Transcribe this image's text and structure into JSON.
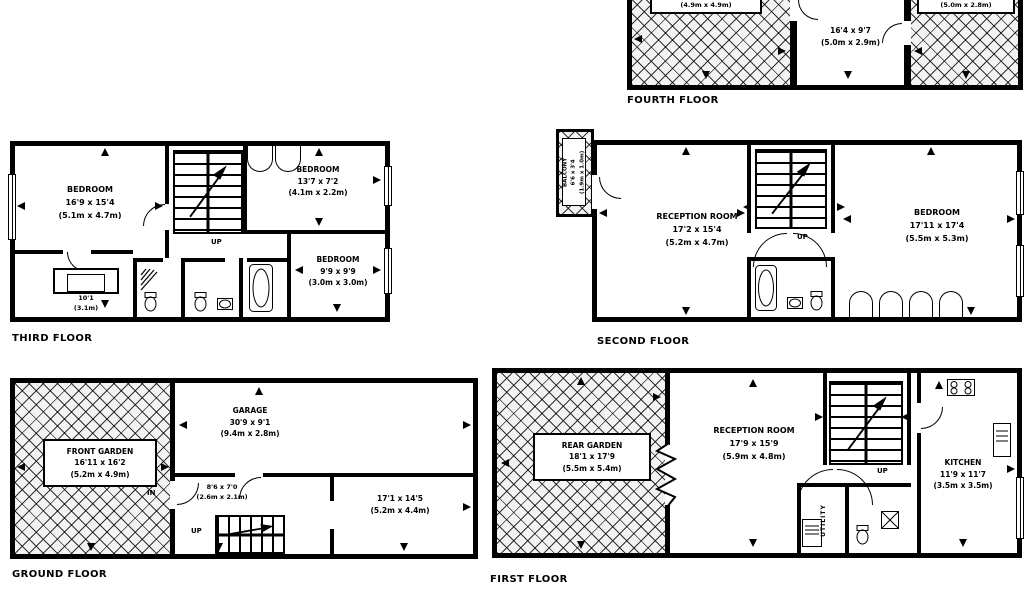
{
  "colors": {
    "ink": "#000000",
    "paper": "#ffffff",
    "hatch_bg": "#f3f3f3"
  },
  "icons": [
    "staircase",
    "bathtub-icon",
    "toilet-icon",
    "sink-icon",
    "shower-spray-icon",
    "stove-icon",
    "washing-machine-icon",
    "fridge-icon",
    "window",
    "door-arc",
    "closet-arc",
    "dimension-arrow",
    "zigzag-break"
  ],
  "floors": {
    "fourth": {
      "label": "FOURTH FLOOR",
      "left_terrace": {
        "m": "(4.9m x 4.9m)"
      },
      "roof_room": {
        "ft": "16'4 x 9'7",
        "m": "(5.0m x 2.9m)"
      },
      "right_terrace": {
        "m": "(5.0m x 2.8m)"
      }
    },
    "third": {
      "label": "THIRD FLOOR",
      "bedroom_main": {
        "name": "BEDROOM",
        "ft": "16'9 x 15'4",
        "m": "(5.1m x 4.7m)"
      },
      "bedroom_front": {
        "name": "BEDROOM",
        "ft": "13'7 x 7'2",
        "m": "(4.1m x 2.2m)"
      },
      "bedroom_small": {
        "name": "BEDROOM",
        "ft": "9'9 x 9'9",
        "m": "(3.0m x 3.0m)"
      },
      "dressing": {
        "ft": "10'1",
        "m": "(3.1m)"
      },
      "up": "UP"
    },
    "second": {
      "label": "SECOND FLOOR",
      "balcony": {
        "name": "BALCONY",
        "ft": "6'6 x 3'4",
        "m": "(1.9m x 1.0m)"
      },
      "reception": {
        "name": "RECEPTION ROOM",
        "ft": "17'2 x 15'4",
        "m": "(5.2m x 4.7m)"
      },
      "bedroom": {
        "name": "BEDROOM",
        "ft": "17'11 x 17'4",
        "m": "(5.5m x 5.3m)"
      },
      "up": "UP"
    },
    "ground": {
      "label": "GROUND FLOOR",
      "front_garden": {
        "name": "FRONT GARDEN",
        "ft": "16'11 x 16'2",
        "m": "(5.2m x 4.9m)"
      },
      "garage": {
        "name": "GARAGE",
        "ft": "30'9 x 9'1",
        "m": "(9.4m x 2.8m)"
      },
      "hall": {
        "ft": "8'6 x 7'0",
        "m": "(2.6m x 2.1m)"
      },
      "rear_room": {
        "ft": "17'1 x 14'5",
        "m": "(5.2m x 4.4m)"
      },
      "in": "IN",
      "up": "UP"
    },
    "first": {
      "label": "FIRST FLOOR",
      "rear_garden": {
        "name": "REAR GARDEN",
        "ft": "18'1 x 17'9",
        "m": "(5.5m x 5.4m)"
      },
      "reception": {
        "name": "RECEPTION ROOM",
        "ft": "17'9 x 15'9",
        "m": "(5.9m x 4.8m)"
      },
      "kitchen": {
        "name": "KITCHEN",
        "ft": "11'9 x 11'7",
        "m": "(3.5m x 3.5m)"
      },
      "utility": "UTILITY",
      "up": "UP"
    }
  }
}
